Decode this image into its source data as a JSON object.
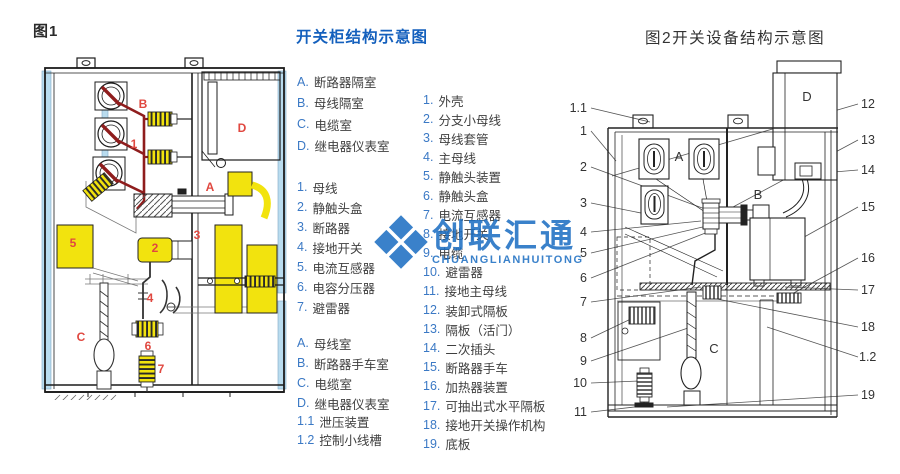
{
  "fig1": {
    "caption": "图1",
    "labels": [
      "B",
      "D",
      "1",
      "A",
      "5",
      "3",
      "2",
      "4",
      "C",
      "6",
      "7"
    ]
  },
  "legend": {
    "title": "开关柜结构示意图",
    "chambers1": [
      {
        "k": "A.",
        "t": "断路器隔室"
      },
      {
        "k": "B.",
        "t": "母线隔室"
      },
      {
        "k": "C.",
        "t": "电缆室"
      },
      {
        "k": "D.",
        "t": "继电器仪表室"
      }
    ],
    "parts1": [
      {
        "k": "1.",
        "t": "母线"
      },
      {
        "k": "2.",
        "t": "静触头盒"
      },
      {
        "k": "3.",
        "t": "断路器"
      },
      {
        "k": "4.",
        "t": "接地开关"
      },
      {
        "k": "5.",
        "t": "电流互感器"
      },
      {
        "k": "6.",
        "t": "电容分压器"
      },
      {
        "k": "7.",
        "t": "避雷器"
      }
    ],
    "chambers2": [
      {
        "k": "A.",
        "t": "母线室"
      },
      {
        "k": "B.",
        "t": "断路器手车室"
      },
      {
        "k": "C.",
        "t": "电缆室"
      },
      {
        "k": "D.",
        "t": "继电器仪表室"
      }
    ],
    "extras": [
      {
        "k": "1.1",
        "t": "泄压装置"
      },
      {
        "k": "1.2",
        "t": "控制小线槽"
      }
    ],
    "parts2": [
      {
        "k": "1.",
        "t": "外壳"
      },
      {
        "k": "2.",
        "t": "分支小母线"
      },
      {
        "k": "3.",
        "t": "母线套管"
      },
      {
        "k": "4.",
        "t": "主母线"
      },
      {
        "k": "5.",
        "t": "静触头装置"
      },
      {
        "k": "6.",
        "t": "静触头盒"
      },
      {
        "k": "7.",
        "t": "电流互感器"
      },
      {
        "k": "8.",
        "t": "接地开关"
      },
      {
        "k": "9.",
        "t": "电缆"
      },
      {
        "k": "10.",
        "t": "避雷器"
      },
      {
        "k": "11.",
        "t": "接地主母线"
      },
      {
        "k": "12.",
        "t": "装卸式隔板"
      },
      {
        "k": "13.",
        "t": "隔板（活门）"
      },
      {
        "k": "14.",
        "t": "二次插头"
      },
      {
        "k": "15.",
        "t": "断路器手车"
      },
      {
        "k": "16.",
        "t": "加热器装置"
      },
      {
        "k": "17.",
        "t": "可抽出式水平隔板"
      },
      {
        "k": "18.",
        "t": "接地开关操作机构"
      },
      {
        "k": "19.",
        "t": "底板"
      }
    ]
  },
  "fig2": {
    "caption": "图2开关设备结构示意图",
    "chambers": [
      "A",
      "B",
      "C",
      "D"
    ],
    "callouts_left": [
      "1.1",
      "1",
      "2",
      "3",
      "4",
      "5",
      "6",
      "7",
      "8",
      "9",
      "10",
      "11"
    ],
    "callouts_right": [
      "12",
      "13",
      "14",
      "15",
      "16",
      "17",
      "18",
      "1.2",
      "19"
    ]
  },
  "watermark": {
    "text": "创联汇通",
    "sub": "CHUANGLIANHUITONG",
    "color": "#1a6dc2"
  }
}
